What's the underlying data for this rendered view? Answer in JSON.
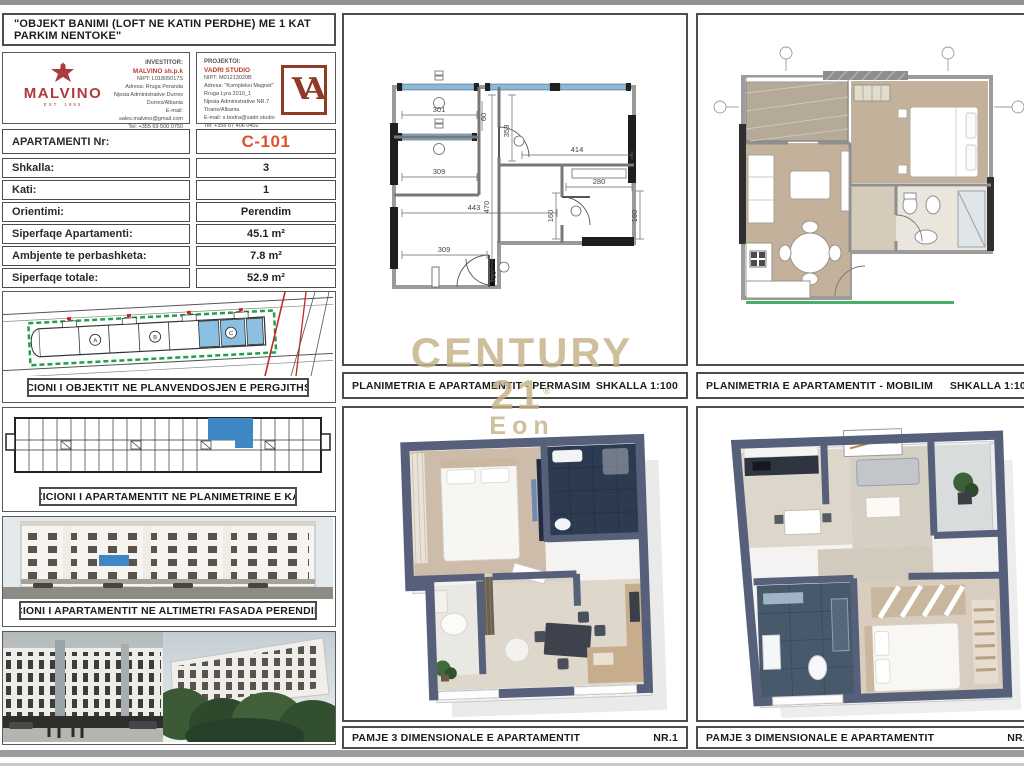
{
  "title": "\"OBJEKT BANIMI (LOFT NE KATIN PERDHE) ME 1 KAT PARKIM NENTOKE\"",
  "header": {
    "investor": {
      "heading": "INVESTITOR:",
      "brand": "MALVINO",
      "brand_sub": "EST. 1995",
      "company": "MALVINO sh.p.k",
      "lines": [
        "NIPT: L01805017S",
        "Adresa: Rruga Peranda",
        "Njesia Administrative Durres",
        "Durres/Albania",
        "E-mail: sales.malvino@gmail.com",
        "Tel: +355 69 500 0750"
      ]
    },
    "designer": {
      "heading": "PROJEKTOI:",
      "studio": "VADRI STUDIO",
      "lines": [
        "NIPT: M01213020B",
        "Adresa: \"Kompleksi Magnet\"",
        "Rruga Lyra 2010_1",
        "Njesia Administrative NR.7",
        "Tirane/Albania",
        "E-mail: s.bodra@vadri.studio",
        "Tel: +355 67 406 0402"
      ],
      "logo_monogram": "VA"
    }
  },
  "info_table": {
    "rows": [
      {
        "label": "APARTAMENTI Nr:",
        "value": "C-101"
      },
      {
        "label": "Shkalla:",
        "value": "3"
      },
      {
        "label": "Kati:",
        "value": "1"
      },
      {
        "label": "Orientimi:",
        "value": "Perendim"
      },
      {
        "label": "Siperfaqe Apartamenti:",
        "value": "45.1 m²"
      },
      {
        "label": "Ambjente te perbashketa:",
        "value": "7.8 m²"
      },
      {
        "label": "Siperfaqe totale:",
        "value": "52.9 m²"
      }
    ]
  },
  "sections": {
    "site": {
      "caption": "POZICIONI I OBJEKTIT NE PLANVENDOSJEN E PERGJITHSHME",
      "units": [
        "A",
        "B",
        "C"
      ]
    },
    "floor": {
      "caption": "POZICIONI I APARTAMENTIT  NE PLANIMETRINE E KATIT"
    },
    "elevation": {
      "caption": "POZICIONI I APARTAMENTIT NE ALTIMETRI  FASADA PERENDIMORE"
    },
    "permasim": {
      "caption": "PLANIMETRIA E APARTAMENTIT - PERMASIM",
      "scale": "SHKALLA 1:100",
      "dims": {
        "d301": "301",
        "d60": "60",
        "d309a": "309",
        "d358": "358",
        "d414": "414",
        "d443": "443",
        "d470": "470",
        "d280": "280",
        "d160a": "160",
        "d160b": "160",
        "d309b": "309",
        "d90": "90"
      }
    },
    "mobilim": {
      "caption": "PLANIMETRIA E APARTAMENTIT - MOBILIM",
      "scale": "SHKALLA 1:100"
    },
    "view1": {
      "caption": "PAMJE 3 DIMENSIONALE E APARTAMENTIT",
      "number": "NR.1"
    },
    "view2": {
      "caption": "PAMJE 3 DIMENSIONALE E APARTAMENTIT",
      "number": "NR.2"
    }
  },
  "watermark": {
    "brand": "CENTURY 21",
    "reg": "®",
    "name": "Eon"
  },
  "colors": {
    "accent_red": "#e2512e",
    "logo_red": "#ae3a3e",
    "highlight_blue": "#3f86c5",
    "site_blue": "#8cc0e2",
    "green": "#1fa04c",
    "watermark_tan": "#c6b287"
  }
}
